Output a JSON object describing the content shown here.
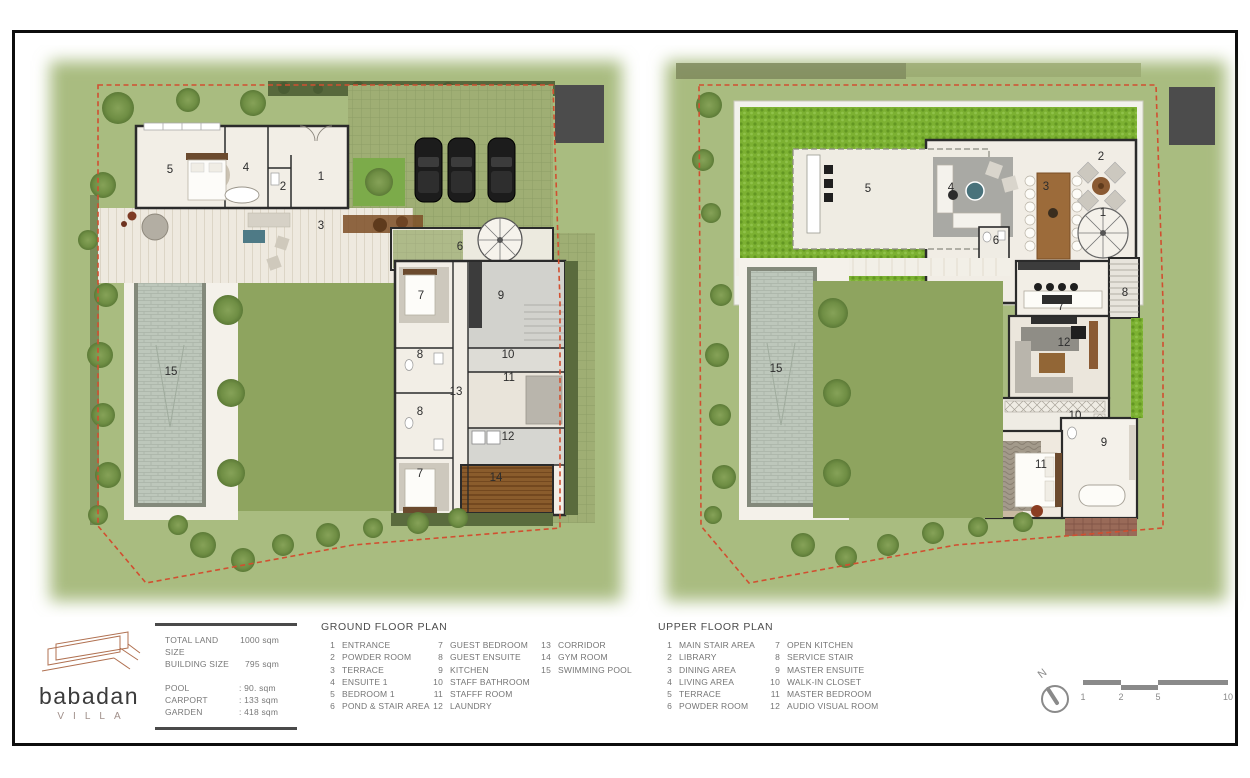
{
  "logo": {
    "name": "babadan",
    "subtitle": "VILLA"
  },
  "info": {
    "size_rows": [
      {
        "label": "TOTAL LAND SIZE",
        "value": "1000 sqm"
      },
      {
        "label": "BUILDING SIZE",
        "value": "795 sqm"
      }
    ],
    "area_rows": [
      {
        "label": "POOL",
        "value": ":   90. sqm"
      },
      {
        "label": "CARPORT",
        "value": ": 133  sqm"
      },
      {
        "label": "GARDEN",
        "value": ": 418  sqm"
      }
    ]
  },
  "ground_plan": {
    "title": "GROUND FLOOR PLAN",
    "legend_columns": [
      [
        {
          "num": "1",
          "label": "ENTRANCE"
        },
        {
          "num": "2",
          "label": "POWDER ROOM"
        },
        {
          "num": "3",
          "label": "TERRACE"
        },
        {
          "num": "4",
          "label": "ENSUITE 1"
        },
        {
          "num": "5",
          "label": "BEDROOM 1"
        },
        {
          "num": "6",
          "label": "POND & STAIR AREA"
        }
      ],
      [
        {
          "num": "7",
          "label": "GUEST BEDROOM"
        },
        {
          "num": "8",
          "label": "GUEST ENSUITE"
        },
        {
          "num": "9",
          "label": "KITCHEN"
        },
        {
          "num": "10",
          "label": "STAFF BATHROOM"
        },
        {
          "num": "11",
          "label": "STAFFF ROOM"
        },
        {
          "num": "12",
          "label": "LAUNDRY"
        }
      ],
      [
        {
          "num": "13",
          "label": "CORRIDOR"
        },
        {
          "num": "14",
          "label": "GYM ROOM"
        },
        {
          "num": "15",
          "label": "SWIMMING POOL"
        }
      ]
    ],
    "markers": [
      {
        "num": "5",
        "x": 142,
        "y": 128
      },
      {
        "num": "4",
        "x": 218,
        "y": 126
      },
      {
        "num": "2",
        "x": 255,
        "y": 145
      },
      {
        "num": "1",
        "x": 293,
        "y": 135
      },
      {
        "num": "3",
        "x": 293,
        "y": 184
      },
      {
        "num": "6",
        "x": 432,
        "y": 205
      },
      {
        "num": "7",
        "x": 393,
        "y": 254
      },
      {
        "num": "9",
        "x": 473,
        "y": 254
      },
      {
        "num": "8",
        "x": 392,
        "y": 313
      },
      {
        "num": "10",
        "x": 480,
        "y": 313
      },
      {
        "num": "11",
        "x": 481,
        "y": 336
      },
      {
        "num": "13",
        "x": 428,
        "y": 350
      },
      {
        "num": "8",
        "x": 392,
        "y": 370
      },
      {
        "num": "12",
        "x": 480,
        "y": 395
      },
      {
        "num": "7",
        "x": 392,
        "y": 432
      },
      {
        "num": "14",
        "x": 468,
        "y": 436
      },
      {
        "num": "15",
        "x": 143,
        "y": 330
      }
    ]
  },
  "upper_plan": {
    "title": "UPPER FLOOR PLAN",
    "legend_columns": [
      [
        {
          "num": "1",
          "label": "MAIN STAIR AREA"
        },
        {
          "num": "2",
          "label": "LIBRARY"
        },
        {
          "num": "3",
          "label": "DINING AREA"
        },
        {
          "num": "4",
          "label": "LIVING AREA"
        },
        {
          "num": "5",
          "label": "TERRACE"
        },
        {
          "num": "6",
          "label": "POWDER ROOM"
        }
      ],
      [
        {
          "num": "7",
          "label": "OPEN KITCHEN"
        },
        {
          "num": "8",
          "label": "SERVICE STAIR"
        },
        {
          "num": "9",
          "label": "MASTER ENSUITE"
        },
        {
          "num": "10",
          "label": "WALK-IN CLOSET"
        },
        {
          "num": "11",
          "label": "MASTER BEDROOM"
        },
        {
          "num": "12",
          "label": "AUDIO VISUAL ROOM"
        }
      ]
    ],
    "markers": [
      {
        "num": "5",
        "x": 227,
        "y": 147
      },
      {
        "num": "4",
        "x": 310,
        "y": 146
      },
      {
        "num": "3",
        "x": 405,
        "y": 145
      },
      {
        "num": "2",
        "x": 460,
        "y": 115
      },
      {
        "num": "1",
        "x": 462,
        "y": 171
      },
      {
        "num": "6",
        "x": 355,
        "y": 199
      },
      {
        "num": "7",
        "x": 420,
        "y": 265
      },
      {
        "num": "8",
        "x": 484,
        "y": 251
      },
      {
        "num": "12",
        "x": 423,
        "y": 301
      },
      {
        "num": "10",
        "x": 434,
        "y": 374
      },
      {
        "num": "9",
        "x": 463,
        "y": 401
      },
      {
        "num": "11",
        "x": 400,
        "y": 423
      },
      {
        "num": "15",
        "x": 135,
        "y": 327
      }
    ]
  },
  "compass": {
    "label": "N"
  },
  "scale_bar": {
    "labels": [
      "1",
      "2",
      "5",
      "10"
    ]
  },
  "colors": {
    "grass": "#a9bc80",
    "lawn": "#8ea45f",
    "boundary_dash": "#d14f30",
    "roof_garden": "#7cb132",
    "pool_water": "#bdc7bb",
    "wall": "#2b2b2b",
    "accent_terracotta": "#b07050",
    "text_grey": "#757575"
  }
}
